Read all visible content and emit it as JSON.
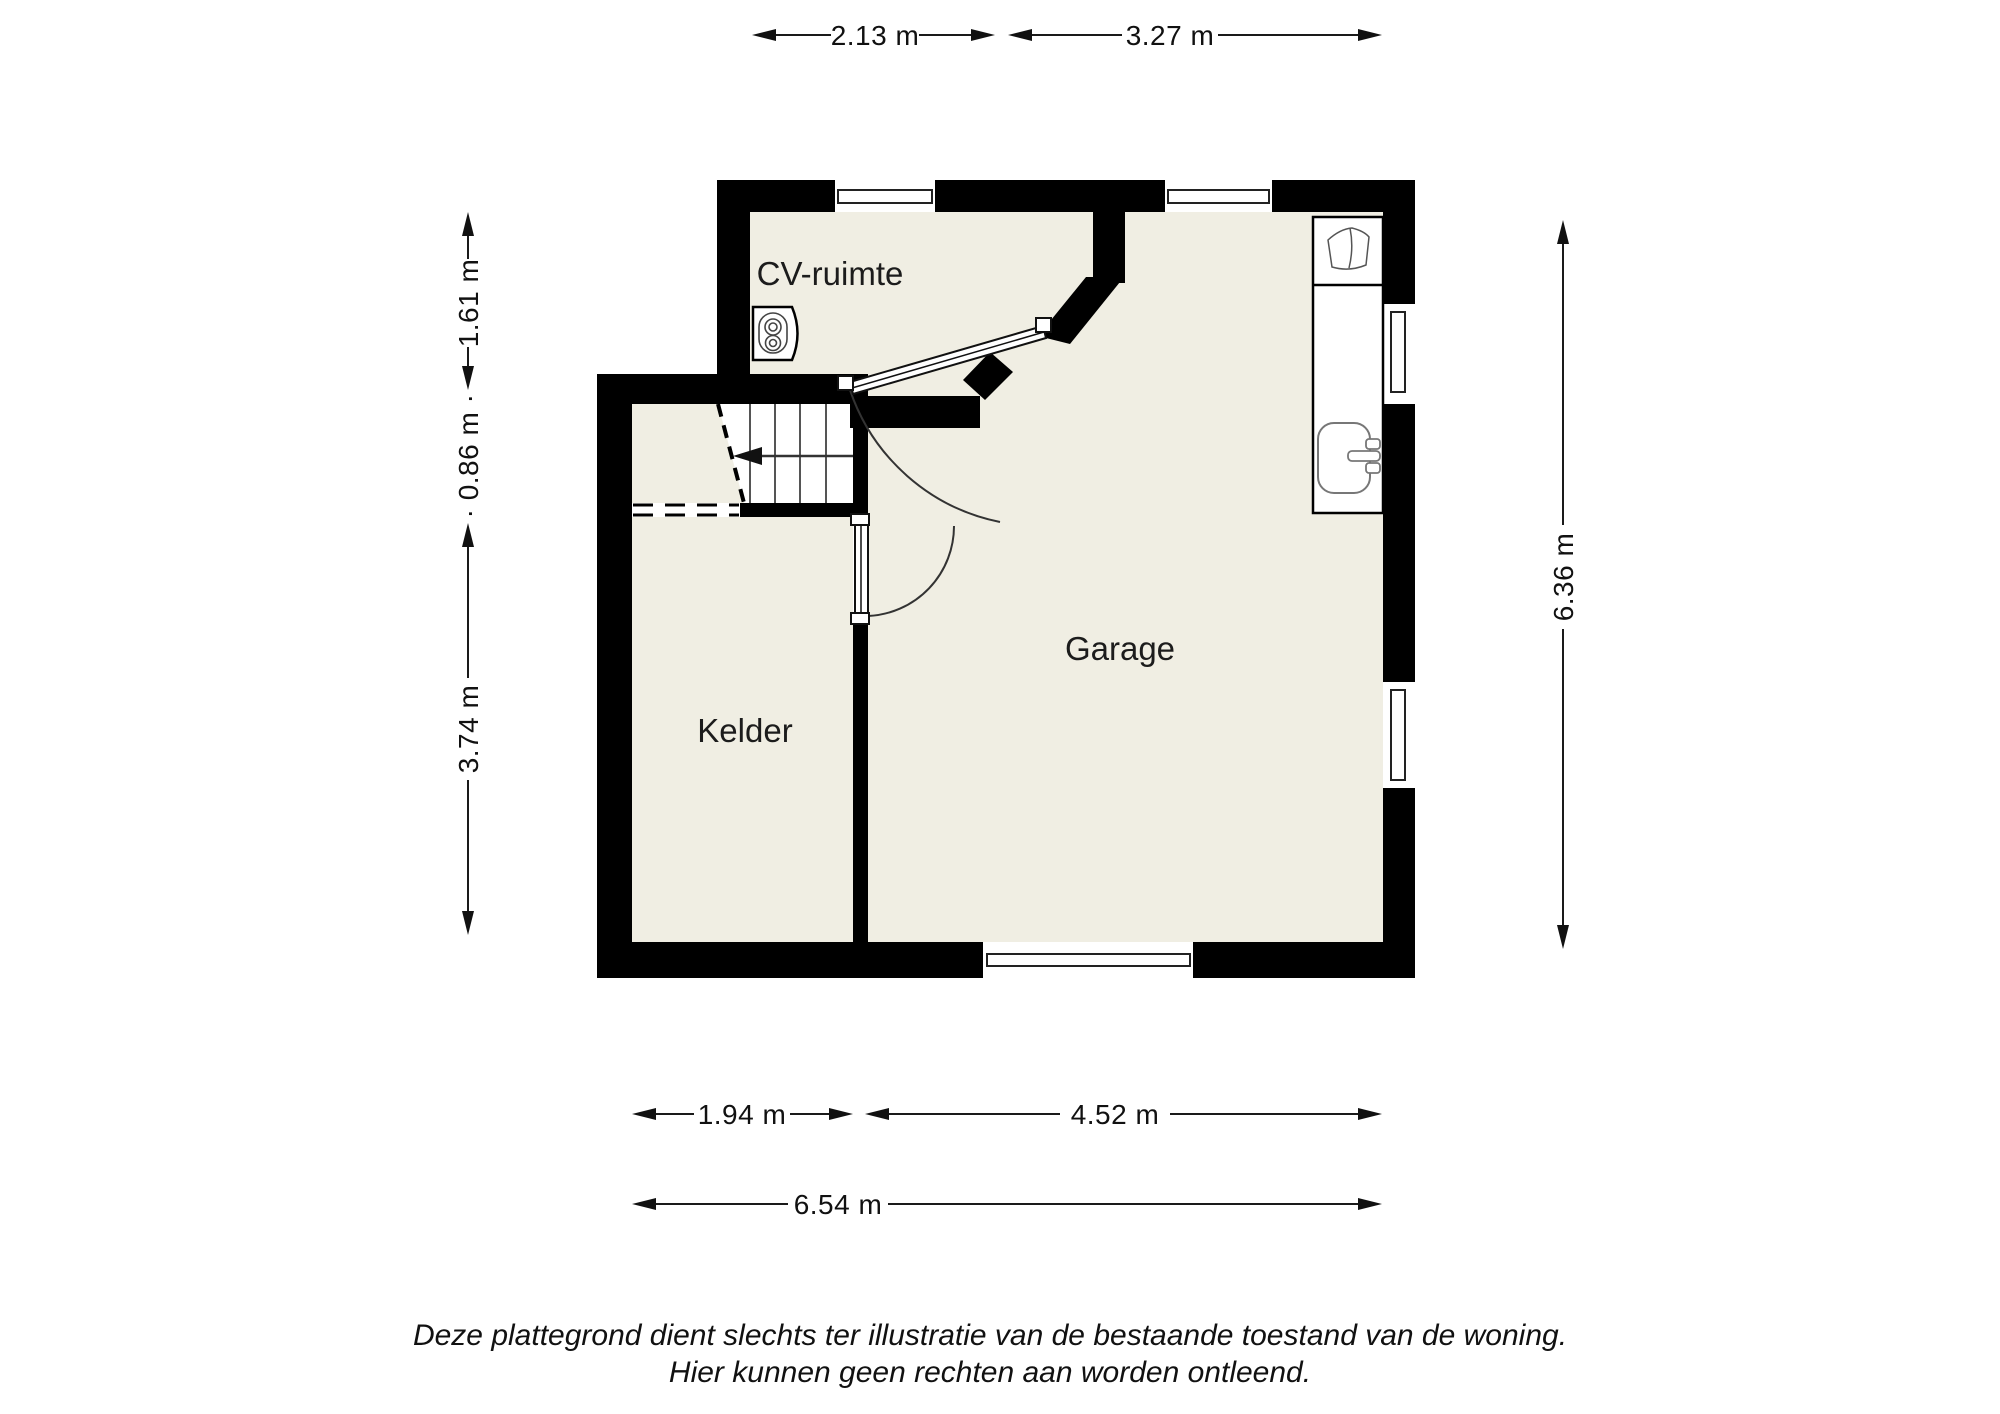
{
  "floorplan": {
    "title": "plattegrond kelderverdieping",
    "colors": {
      "floor": "#f0eee3",
      "wall": "#000000",
      "dimension_line": "#1a1a1a",
      "fixture_line": "#666666"
    },
    "rooms": [
      {
        "id": "cv_ruimte",
        "label": "CV-ruimte"
      },
      {
        "id": "garage",
        "label": "Garage"
      },
      {
        "id": "kelder",
        "label": "Kelder"
      }
    ],
    "fixtures": [
      {
        "icon": "boiler-icon",
        "room": "CV-ruimte"
      },
      {
        "icon": "stairs",
        "room": "Kelder"
      },
      {
        "icon": "laundry-basin-icon",
        "room": "Garage"
      },
      {
        "icon": "sink-icon",
        "room": "Garage"
      },
      {
        "icon": "door-swing",
        "room": "CV-ruimte"
      },
      {
        "icon": "door-swing",
        "room": "Kelder"
      },
      {
        "icon": "window",
        "room": "Garage"
      }
    ]
  },
  "dimensions": {
    "top": [
      {
        "label": "2.13 m"
      },
      {
        "label": "3.27 m"
      }
    ],
    "left": [
      {
        "label": "1.61 m"
      },
      {
        "label": "· 0.86 m ·"
      },
      {
        "label": "3.74 m"
      }
    ],
    "right": [
      {
        "label": "6.36 m"
      }
    ],
    "bottom": [
      {
        "label": "1.94 m"
      },
      {
        "label": "4.52 m"
      }
    ],
    "bottom_total": [
      {
        "label": "6.54 m"
      }
    ]
  },
  "disclaimer": {
    "line1": "Deze plattegrond dient slechts ter illustratie van de bestaande toestand van de woning.",
    "line2": "Hier kunnen geen rechten aan worden ontleend."
  }
}
